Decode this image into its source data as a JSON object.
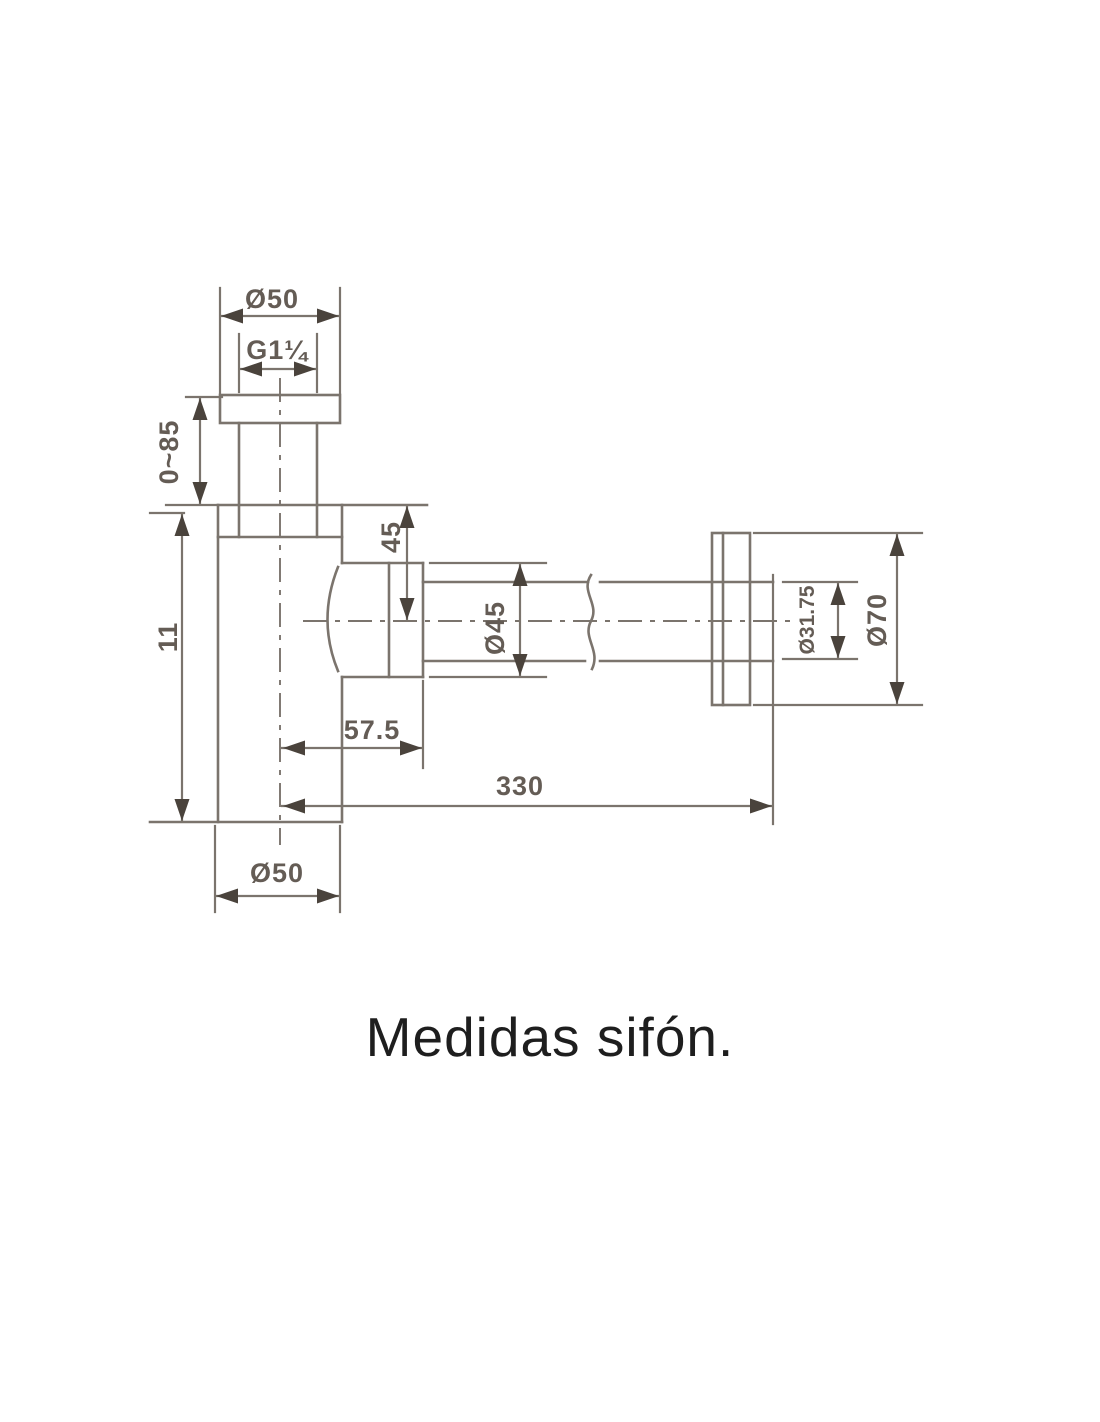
{
  "caption": "Medidas sifón.",
  "colors": {
    "line": "#7b746d",
    "arrow": "#4a433c",
    "dim_text": "#645c55",
    "caption_text": "#1e1e1e",
    "background": "#ffffff"
  },
  "drawing": {
    "subject": "bottle-trap-siphon-side-view",
    "dims": {
      "top_flange_diameter": "Ø50",
      "inlet_thread": "G1¼",
      "adjustable_inlet_height": "0~85",
      "body_height": "11",
      "body_top_to_pipe_center": "45",
      "socket_nut_diameter": "Ø45",
      "center_to_socket_end": "57.5",
      "center_to_wall_length": "330",
      "body_diameter": "Ø50",
      "pipe_diameter": "Ø31.75",
      "wall_flange_diameter": "Ø70"
    }
  }
}
